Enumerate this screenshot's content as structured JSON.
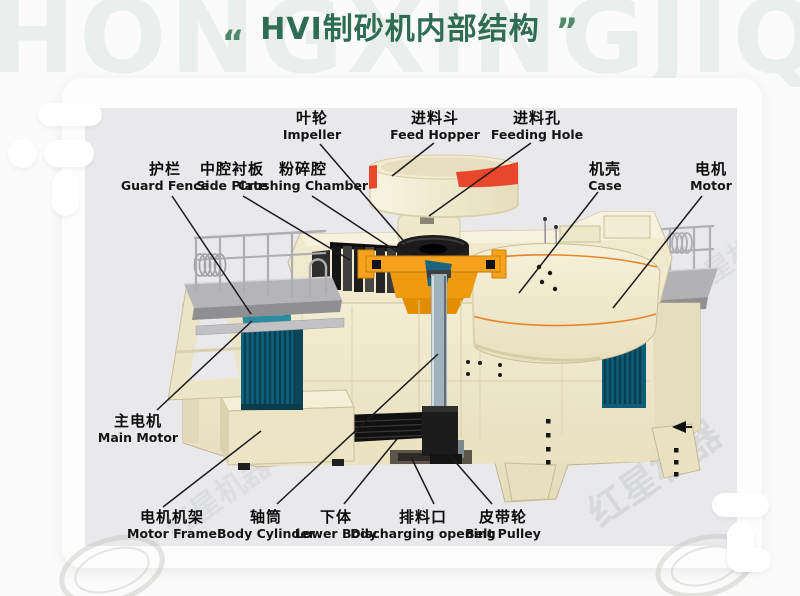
{
  "header": {
    "watermark": "HONGXINGJIQI",
    "quote_open": "“",
    "quote_close": "”",
    "title": "HVI制砂机内部结构"
  },
  "watermarks": {
    "diagonal_text": "红星机器",
    "diagonal_text_small": "红星机器"
  },
  "colors": {
    "title_green": "#2e6d53",
    "panel_gray": "#e9e9ec",
    "machine_cream": "#f1ead0",
    "accent_red": "#e8472b",
    "accent_orange": "#f6a21c",
    "motor_teal": "#10617c"
  },
  "diagram": {
    "labels": [
      {
        "id": "impeller",
        "cn": "叶轮",
        "en": "Impeller"
      },
      {
        "id": "feed-hopper",
        "cn": "进料斗",
        "en": "Feed Hopper"
      },
      {
        "id": "feeding-hole",
        "cn": "进料孔",
        "en": "Feeding Hole"
      },
      {
        "id": "guard-fence",
        "cn": "护栏",
        "en": "Guard Fence"
      },
      {
        "id": "side-plate",
        "cn": "中腔衬板",
        "en": "Side Plate"
      },
      {
        "id": "crushing-chamber",
        "cn": "粉碎腔",
        "en": "Crushing Chamber"
      },
      {
        "id": "case",
        "cn": "机壳",
        "en": "Case"
      },
      {
        "id": "motor",
        "cn": "电机",
        "en": "Motor"
      },
      {
        "id": "main-motor",
        "cn": "主电机",
        "en": "Main Motor"
      },
      {
        "id": "motor-frame",
        "cn": "电机机架",
        "en": "Motor Frame"
      },
      {
        "id": "body-cylinder",
        "cn": "轴筒",
        "en": "Body Cylinder"
      },
      {
        "id": "lower-body",
        "cn": "下体",
        "en": "Lower Body"
      },
      {
        "id": "discharging-opening",
        "cn": "排料口",
        "en": "Discharging opening"
      },
      {
        "id": "belt-pulley",
        "cn": "皮带轮",
        "en": "Belt Pulley"
      }
    ]
  }
}
